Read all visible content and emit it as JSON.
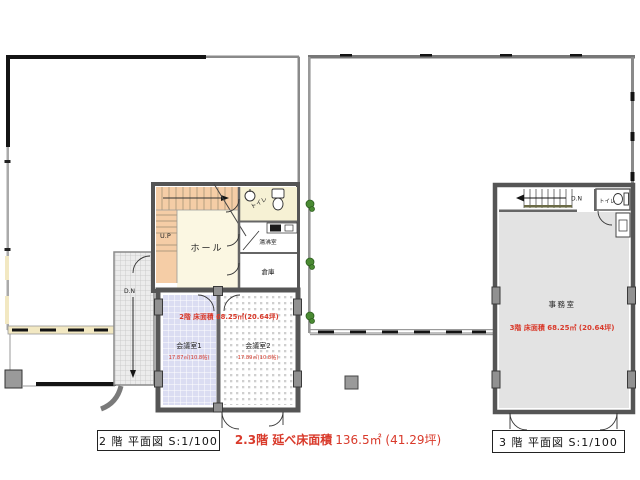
{
  "plan_2f": {
    "caption": "2 階 平面図 S:1/100",
    "floor_area_label": "2階 床面積 68.25㎡(20.64坪)",
    "stairs_up_label": "U.P",
    "stairs_down_label": "D.N",
    "rooms": {
      "hall": "ホール",
      "toilet": "トイレ",
      "kitchenette": "湯沸室",
      "storage": "倉庫",
      "meeting_room_1": "会議室1",
      "meeting_room_1_area": "17.87㎡(10.8帖)",
      "meeting_room_2": "会議室2",
      "meeting_room_2_area": "17.89㎡(10.8帖)"
    }
  },
  "plan_3f": {
    "caption": "3 階 平面図 S:1/100",
    "floor_area_label": "3階 床面積  68.25㎡ (20.64坪)",
    "stairs_down_label": "D.N",
    "rooms": {
      "office": "事務室",
      "toilet": "トイレ"
    }
  },
  "footer": {
    "total_label": "2.3階 延べ床面積",
    "total_value": "136.5㎡ (41.29坪)"
  },
  "colors": {
    "annotation_red": "#d93a2b",
    "wall_dark": "#555555",
    "office_fill": "#e3e3e3",
    "meeting1_fill": "#dbddf2",
    "stair_fill": "#f5cda6",
    "hall_fill": "#fbf7e2",
    "toilet_fill": "#f6f1d4",
    "window_band": "#f2e8c2"
  }
}
